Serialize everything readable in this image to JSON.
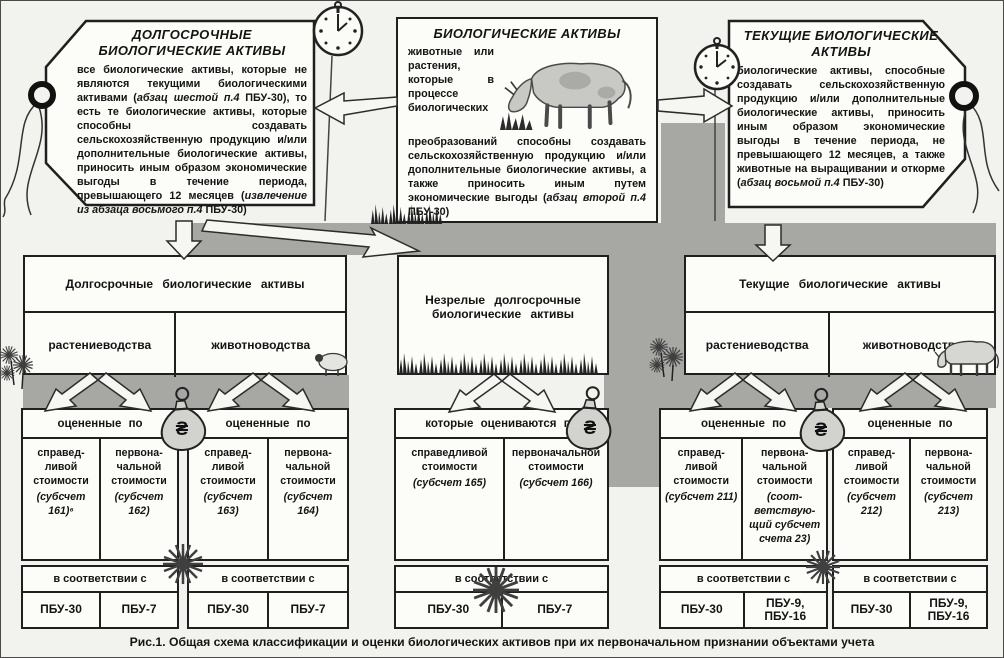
{
  "page": {
    "caption": "Рис.1. Общая схема классификации и оценки биологических активов при их первоначальном признании объектами учета"
  },
  "top_boxes": {
    "biological": {
      "title": "БИОЛОГИЧЕСКИЕ АКТИВЫ",
      "body": [
        {
          "t": "животные или растения, которые в процессе биологических преобразований способны создавать сельскохозяйственную продукцию и/или дополнительные биологические активы, а также приносить иным путем экономические выгоды ("
        },
        {
          "t": "абзац второй п.4",
          "i": true
        },
        {
          "t": " "
        },
        {
          "t": "ПБУ-30",
          "b": true
        },
        {
          "t": ")"
        }
      ]
    },
    "longterm": {
      "title": "ДОЛГОСРОЧНЫЕ БИОЛОГИЧЕСКИЕ АКТИВЫ",
      "body": [
        {
          "t": "все биологические активы, которые не являются текущими биологическими активами ("
        },
        {
          "t": "абзац шестой п.4",
          "i": true
        },
        {
          "t": " "
        },
        {
          "t": "ПБУ-30",
          "b": true
        },
        {
          "t": "), то есть те биологические активы, которые способны создавать сельскохозяйственную продукцию и/или дополнительные биологические активы, приносить иным образом экономические выгоды в течение периода, превышающего 12 месяцев ("
        },
        {
          "t": "извлечение из абзаца восьмого п.4",
          "i": true
        },
        {
          "t": " "
        },
        {
          "t": "ПБУ-30",
          "b": true
        },
        {
          "t": ")"
        }
      ]
    },
    "current": {
      "title": "ТЕКУЩИЕ БИОЛОГИЧЕСКИЕ АКТИВЫ",
      "body": [
        {
          "t": "биологические активы, способные создавать сельскохозяйственную продукцию и/или дополнительные биологические активы, приносить иным образом экономические выгоды в течение периода, не превышающего 12 месяцев, а также животные на выращивании и откорме ("
        },
        {
          "t": "абзац восьмой п.4",
          "i": true
        },
        {
          "t": " "
        },
        {
          "t": "ПБУ-30",
          "b": true
        },
        {
          "t": ")"
        }
      ]
    }
  },
  "middle": {
    "longterm": {
      "title": "Долгосрочные биологические активы",
      "cells": [
        "растениеводства",
        "животноводства"
      ]
    },
    "immature": {
      "title": "Незрелые долгосрочные биологические активы"
    },
    "current": {
      "title": "Текущие биологические активы",
      "cells": [
        "растениеводства",
        "животноводства"
      ]
    }
  },
  "groups": [
    {
      "header": "оцененные по",
      "cells": [
        {
          "label": "справед­ливой стоимости",
          "sub": "(субсчет 161)⁶"
        },
        {
          "label": "первона­чальной стоимости",
          "sub": "(субсчет 162)"
        }
      ],
      "accordance": "в соответствии с",
      "standards": [
        "ПБУ-30",
        "ПБУ-7"
      ]
    },
    {
      "header": "оцененные по",
      "cells": [
        {
          "label": "справед­ливой стоимос­ти",
          "sub": "(субсчет 163)"
        },
        {
          "label": "первона­чальной стоимости",
          "sub": "(субсчет 164)"
        }
      ],
      "accordance": "в соответствии с",
      "standards": [
        "ПБУ-30",
        "ПБУ-7"
      ]
    },
    {
      "header": "которые оцениваются по",
      "cells": [
        {
          "label": "справедливой стоимости",
          "sub": "(субсчет 165)"
        },
        {
          "label": "первоначаль­ной стоимости",
          "sub": "(субсчет 166)"
        }
      ],
      "accordance": "в соответствии с",
      "standards": [
        "ПБУ-30",
        "ПБУ-7"
      ]
    },
    {
      "header": "оцененные по",
      "cells": [
        {
          "label": "справед­ливой стоимос­ти",
          "sub": "(субсчет 211)"
        },
        {
          "label": "первона­чальной стоимости",
          "sub": "(соот­ветствую­щий субсчет счета 23)"
        }
      ],
      "accordance": "в соответствии с",
      "standards": [
        "ПБУ-30",
        "ПБУ-9, ПБУ-16"
      ]
    },
    {
      "header": "оцененные по",
      "cells": [
        {
          "label": "справед­ливой стоимос­ти",
          "sub": "(субсчет 212)"
        },
        {
          "label": "первона­чальной стоимости",
          "sub": "(субсчет 213)"
        }
      ],
      "accordance": "в соответствии с",
      "standards": [
        "ПБУ-30",
        "ПБУ-9, ПБУ-16"
      ]
    }
  ],
  "icons": {
    "currency": "₴"
  },
  "colors": {
    "paper": "#f2f2ee",
    "band_gray": "#a7a7a4",
    "box_fill": "#fcfcf9",
    "line": "#1f1f1f"
  }
}
